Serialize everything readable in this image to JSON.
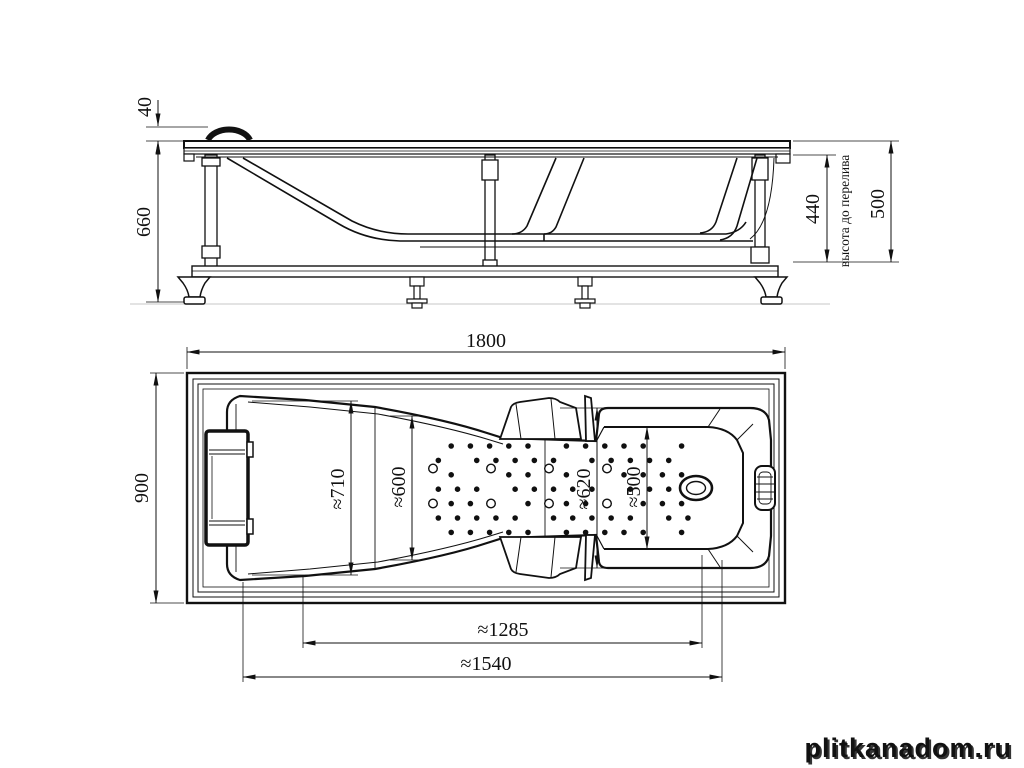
{
  "side_view": {
    "dim_headrest_height": "40",
    "dim_total_height": "660",
    "dim_overflow_height": "440",
    "overflow_label": "высота до перелива",
    "dim_rim_to_bottom": "500"
  },
  "plan_view": {
    "dim_length": "1800",
    "dim_width": "900",
    "dim_head_inner_width": "≈710",
    "dim_mid_inner_width": "≈600",
    "dim_foot_outer_width": "≈620",
    "dim_foot_inner_width": "≈500",
    "dim_bottom_length": "≈1285",
    "dim_shell_length": "≈1540",
    "jets": {
      "cols": 14,
      "rows": 7,
      "x0": 432,
      "y0": 446,
      "dx": 19.2,
      "dy": 14.4,
      "dot_r": 2.3,
      "ring_r": 4.3,
      "rings_x": [
        433,
        491,
        549,
        607
      ],
      "rings_y": [
        468.5,
        503.5
      ]
    }
  },
  "watermark": {
    "text": "plitkanadom.ru"
  }
}
